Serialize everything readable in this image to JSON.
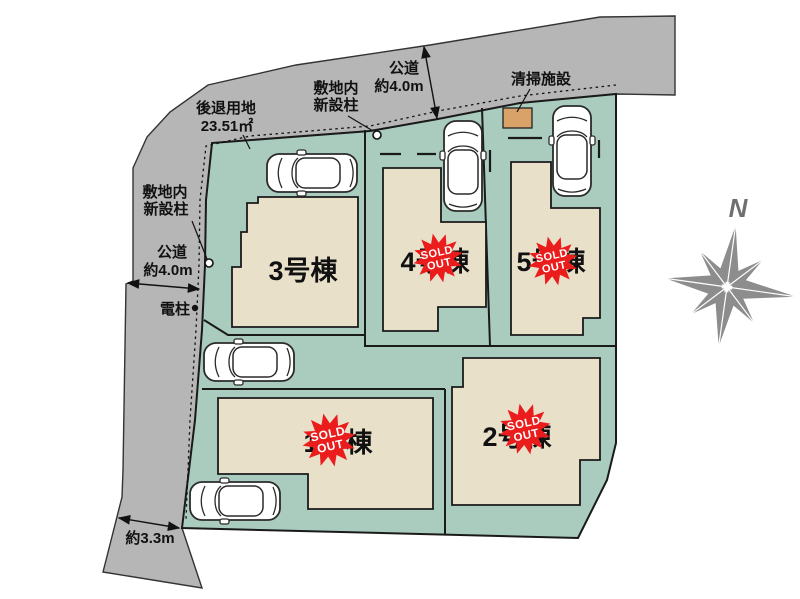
{
  "plan": {
    "buildings": [
      {
        "label": "1号棟",
        "sold": true
      },
      {
        "label": "2号棟",
        "sold": true
      },
      {
        "label": "3号棟",
        "sold": false
      },
      {
        "label": "4号棟",
        "sold": true
      },
      {
        "label": "5号棟",
        "sold": true
      }
    ],
    "badge": {
      "line1": "SOLD",
      "line2": "OUT"
    },
    "labels": {
      "setback1": "後退用地",
      "setback2": "23.51㎡",
      "pole1": "敷地内",
      "pole2": "新設柱",
      "road_top1": "公道",
      "road_top2": "約4.0m",
      "road_left1": "公道",
      "road_left2": "約4.0m",
      "cleaning": "清掃施設",
      "utility_pole": "電柱",
      "bottom_width": "約3.3m",
      "north": "N"
    },
    "colors": {
      "road": "#b6b6b6",
      "site": "#a9ccbe",
      "building": "#e9e0ca",
      "facility": "#d8a268",
      "sold_red": "#ea1c1c",
      "compass": "#8d8d8d",
      "car": "#ffffff"
    }
  }
}
